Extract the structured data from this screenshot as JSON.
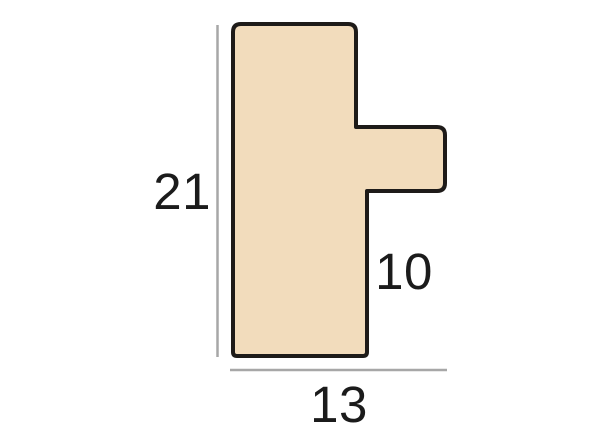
{
  "diagram": {
    "kind": "moulding-profile-cross-section",
    "dimensions": {
      "height_label": "21",
      "rebate_label": "10",
      "width_label": "13"
    }
  },
  "profile": {
    "fill_color": "#f2dcbc",
    "outline_color": "#1e1b19"
  },
  "dimension_lines": {
    "color": "#a7a7a7"
  }
}
